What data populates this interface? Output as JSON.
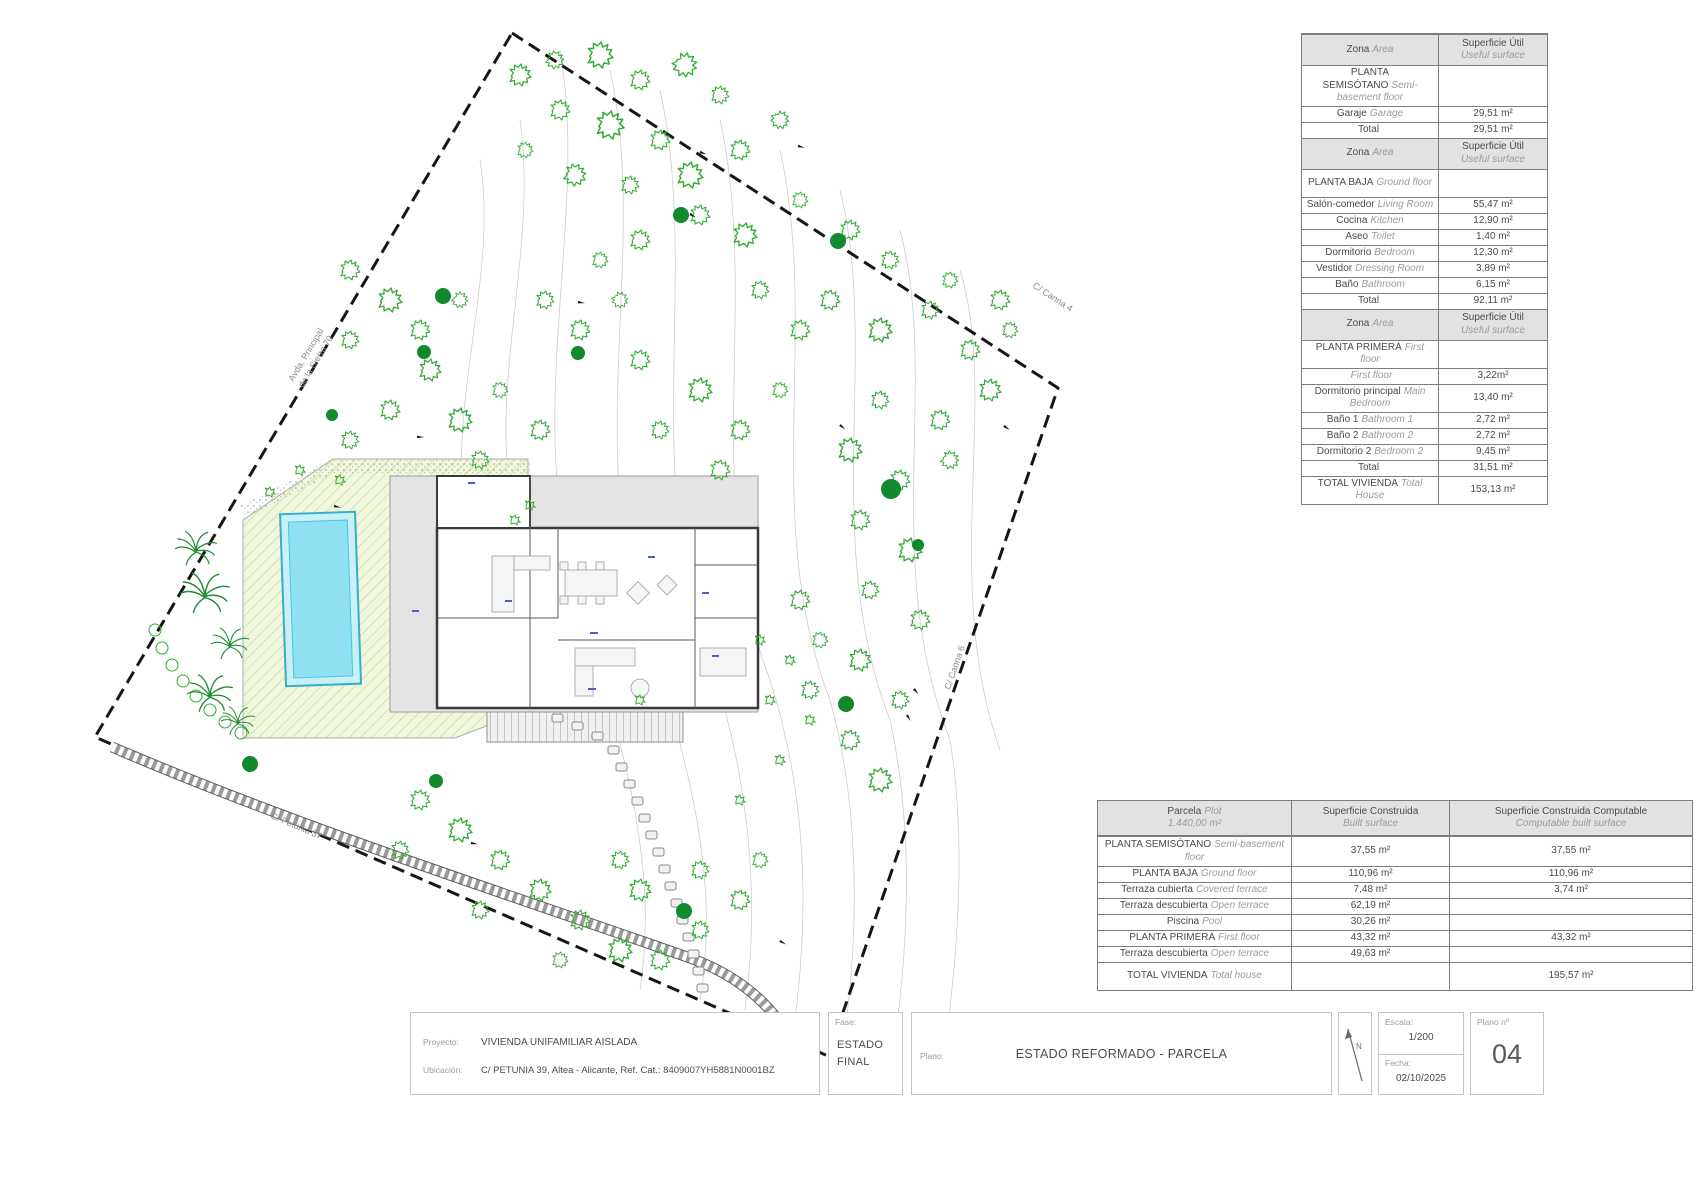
{
  "plan": {
    "labels": {
      "calle_line1": "CALLE",
      "calle_line2": "PETUNIA",
      "canna4": "C/ Canna 4",
      "canna6": "C/ Canna 6",
      "petunia37": "C/ Petunia 37",
      "avda_line1": "Avda. Principal",
      "avda_line2": "de la Sierra 70"
    }
  },
  "tables": {
    "useful": {
      "rows": [
        {
          "type": "header",
          "es": "Zona",
          "en": "Area",
          "val": "Superficie Útil",
          "val2": "Useful surface"
        },
        {
          "type": "section",
          "es": "PLANTA SEMISÓTANO",
          "en": "Semi-basement floor",
          "val": ""
        },
        {
          "type": "item",
          "es": "Garaje",
          "en": "Garage",
          "val": "29,51 m²"
        },
        {
          "type": "total",
          "es": "Total",
          "en": "",
          "val": "29,51 m²"
        },
        {
          "type": "header",
          "es": "Zona",
          "en": "Area",
          "val": "Superficie Útil",
          "val2": "Useful surface"
        },
        {
          "type": "section",
          "es": "PLANTA BAJA",
          "en": "Ground floor",
          "val": ""
        },
        {
          "type": "item",
          "es": "Salón-comedor",
          "en": "Living Room",
          "val": "55,47 m²"
        },
        {
          "type": "item",
          "es": "Cocina",
          "en": "Kitchen",
          "val": "12,90 m²"
        },
        {
          "type": "item",
          "es": "Aseo",
          "en": "Toilet",
          "val": "1,40 m²"
        },
        {
          "type": "item",
          "es": "Dormitorio",
          "en": "Bedroom",
          "val": "12,30 m²"
        },
        {
          "type": "item",
          "es": "Vestidor",
          "en": "Dressing Room",
          "val": "3,89 m²"
        },
        {
          "type": "item",
          "es": "Baño",
          "en": "Bathroom",
          "val": "6,15 m²"
        },
        {
          "type": "total",
          "es": "Total",
          "en": "",
          "val": "92,11 m²"
        },
        {
          "type": "header",
          "es": "Zona",
          "en": "Area",
          "val": "Superficie Útil",
          "val2": "Useful surface"
        },
        {
          "type": "section",
          "es": "PLANTA PRIMERA",
          "en": "First floor",
          "val": ""
        },
        {
          "type": "item",
          "es": "",
          "en": "First floor",
          "val": "3,22m²"
        },
        {
          "type": "item",
          "es": "Dormitorio principal",
          "en": "Main Bedroom",
          "val": "13,40 m²"
        },
        {
          "type": "item",
          "es": "Baño 1",
          "en": "Bathroom 1",
          "val": "2,72 m²"
        },
        {
          "type": "item",
          "es": "Baño 2",
          "en": "Bathroom 2",
          "val": "2,72 m²"
        },
        {
          "type": "item",
          "es": "Dormitorio 2",
          "en": "Bedroom 2",
          "val": "9,45 m²"
        },
        {
          "type": "total",
          "es": "Total",
          "en": "",
          "val": "31,51 m²"
        },
        {
          "type": "grand",
          "es": "TOTAL VIVIENDA",
          "en": "Total House",
          "val": "153,13 m²"
        }
      ]
    },
    "built": {
      "header": {
        "parcela_es": "Parcela",
        "parcela_en": "Plot",
        "parcela_sub": "1.440,00 m²",
        "built_es": "Superficie Construida",
        "built_en": "Built surface",
        "comp_es": "Superficie Construida Computable",
        "comp_en": "Computable built surface"
      },
      "rows": [
        {
          "type": "tall",
          "es": "PLANTA SEMISÓTANO",
          "en": "Semi-basement floor",
          "built": "37,55 m²",
          "comp": "37,55 m²"
        },
        {
          "type": "item",
          "es": "PLANTA BAJA",
          "en": "Ground floor",
          "built": "110,96 m²",
          "comp": "110,96 m²"
        },
        {
          "type": "item",
          "es": "Terraza cubierta",
          "en": "Covered terrace",
          "built": "7,48 m²",
          "comp": "3,74 m²"
        },
        {
          "type": "item",
          "es": "Terraza descubierta",
          "en": "Open terrace",
          "built": "62,19 m²",
          "comp": ""
        },
        {
          "type": "item",
          "es": "Piscina",
          "en": "Pool",
          "built": "30,26 m²",
          "comp": ""
        },
        {
          "type": "item",
          "es": "PLANTA PRIMERA",
          "en": "First floor",
          "built": "43,32 m²",
          "comp": "43,32 m²"
        },
        {
          "type": "item",
          "es": "Terraza descubierta",
          "en": "Open terrace",
          "built": "49,63 m²",
          "comp": ""
        },
        {
          "type": "grand",
          "es": "TOTAL VIVIENDA",
          "en": "Total house",
          "built": "",
          "comp": "195,57 m²"
        }
      ]
    }
  },
  "titleblock": {
    "proyecto_label": "Proyecto:",
    "proyecto": "VIVIENDA UNIFAMILIAR AISLADA",
    "ubicacion_label": "Ubicación:",
    "ubicacion": "C/ PETUNIA 39, Altea - Alicante, Ref. Cat.: 8409007YH5881N0001BZ",
    "fase_label": "Fase:",
    "fase_line1": "ESTADO",
    "fase_line2": "FINAL",
    "plano_label": "Plano:",
    "plano": "ESTADO REFORMADO - PARCELA",
    "north": "N",
    "escala_label": "Escala:",
    "escala": "1/200",
    "fecha_label": "Fecha:",
    "fecha": "02/10/2025",
    "plano_n_label": "Plano nº",
    "plano_n": "04"
  }
}
